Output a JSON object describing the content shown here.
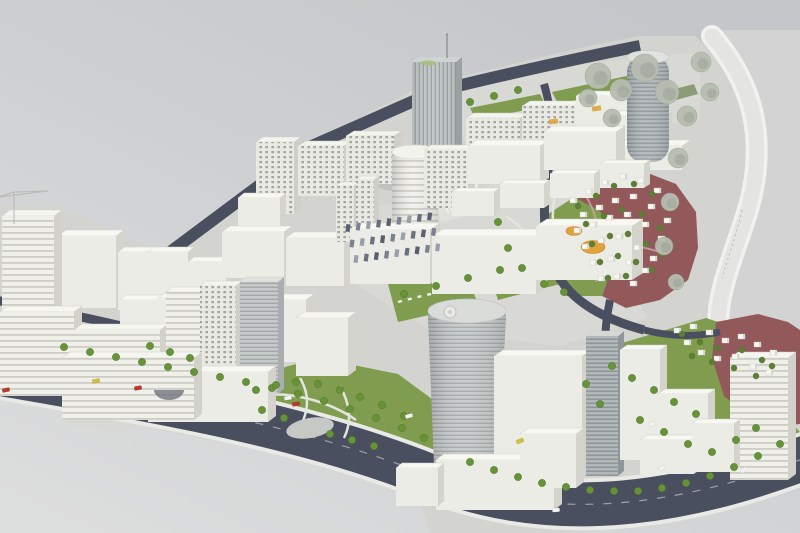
{
  "image": {
    "title": "Architectural scale model of a city district master plan",
    "width": 800,
    "height": 533
  },
  "palette": {
    "bg_top": "#C4C6C9",
    "bg_bottom": "#DCDDDD",
    "platform": "#D3D4CF",
    "pavement": "#D8D9D4",
    "pavement_light": "#E0E1DB",
    "river": "#D2D3D2",
    "bank_road": "#E4E5E2",
    "bank_edge": "#F1F1EE",
    "road": "#4A4F60",
    "road_edge": "#E9E9E5",
    "grass": "#7F9C4F",
    "grass_deep": "#6F8A42",
    "grass_muted": "#8E9B78",
    "path": "#E4E5DE",
    "maroon": "#92585A",
    "maroon_path": "#C9ABA9",
    "orange": "#E0A33C",
    "pond": "#C6C8C6",
    "tree_green": "#679338",
    "tree_green_dark": "#557C2C",
    "tree_red_district": "#5E7D36",
    "tree_gray": "#B7BDB1",
    "tree_gray_dark": "#99A294",
    "house": "#F7F7F2",
    "house_side": "#D8D8D2",
    "car_red": "#B53A31",
    "car_yellow": "#D2C03A",
    "car_white": "#F2F2F0",
    "shadow": "rgba(40,42,50,0.10)",
    "grid_bg": "#E9E9E3",
    "grid_dot": "#A3A49E",
    "ribbon_bg": "#F0F0EB",
    "ribbon_line": "#CDCDC5",
    "glass_bg": "#C6CAC9",
    "glass_line": "#A2A8A9",
    "glassdark_bg": "#B2B8BA",
    "glassdark_line": "#8F969A",
    "vglass_bg": "#C2C8C7",
    "vglass_line": "#9AA1A1"
  },
  "styles": {
    "white": {
      "front": "#ECECE6",
      "top": "#F8F8F3",
      "side": "#D4D4CD"
    },
    "grid": {
      "front": "url(#pat-grid)",
      "top": "#F4F4EE",
      "side": "#CFCFC8"
    },
    "ribbon": {
      "front": "url(#pat-ribbon)",
      "top": "#F6F6F1",
      "side": "#D2D2CB"
    },
    "glass": {
      "front": "url(#pat-h)",
      "top": "#DFE1DF",
      "side": "#A9AEB0"
    },
    "gdark": {
      "front": "url(#pat-hd)",
      "top": "#D6D8D6",
      "side": "#8F969A"
    },
    "vglass": {
      "front": "url(#pat-v)",
      "top": "#CFD4D2",
      "side": "#9AA1A1"
    }
  },
  "buildings_back": [
    [
      "office-slab-a",
      58,
      236,
      58,
      72,
      8,
      6,
      "white"
    ],
    [
      "office-slab-b",
      118,
      252,
      44,
      58,
      7,
      5,
      "white"
    ],
    [
      "construction-highrise",
      2,
      216,
      52,
      96,
      8,
      6,
      "ribbon"
    ],
    [
      "office-box-a",
      148,
      252,
      40,
      42,
      6,
      5,
      "white"
    ],
    [
      "office-box-b",
      188,
      262,
      38,
      36,
      6,
      5,
      "white"
    ],
    [
      "apartment-tower",
      256,
      142,
      38,
      72,
      7,
      5,
      "grid"
    ],
    [
      "apartment-slab-a",
      298,
      146,
      46,
      50,
      8,
      5,
      "grid"
    ],
    [
      "apartment-slab-b",
      346,
      136,
      48,
      48,
      8,
      5,
      "grid"
    ],
    [
      "apartment-slab-c",
      466,
      118,
      54,
      44,
      8,
      5,
      "grid"
    ],
    [
      "apartment-slab-d",
      522,
      106,
      54,
      42,
      8,
      5,
      "grid"
    ],
    [
      "back-block-a",
      576,
      96,
      52,
      38,
      8,
      5,
      "white"
    ],
    [
      "back-block-b",
      610,
      116,
      54,
      34,
      8,
      5,
      "white"
    ],
    [
      "podium-right-tower",
      606,
      146,
      76,
      24,
      9,
      6,
      "white"
    ],
    [
      "podium-center-tower",
      396,
      168,
      82,
      24,
      9,
      6,
      "white"
    ]
  ],
  "buildings_mid": [
    [
      "grid-slab-center",
      424,
      150,
      44,
      58,
      7,
      5,
      "grid"
    ],
    [
      "campus-block-a",
      468,
      146,
      72,
      38,
      9,
      6,
      "white"
    ],
    [
      "campus-block-b",
      544,
      132,
      72,
      38,
      9,
      6,
      "white"
    ],
    [
      "campus-row-a",
      452,
      192,
      42,
      24,
      6,
      4,
      "white"
    ],
    [
      "campus-row-b",
      500,
      184,
      44,
      24,
      6,
      4,
      "white"
    ],
    [
      "campus-row-c",
      550,
      174,
      44,
      24,
      6,
      4,
      "white"
    ],
    [
      "campus-row-d",
      600,
      164,
      44,
      24,
      6,
      4,
      "white"
    ],
    [
      "mid-block-a",
      238,
      198,
      42,
      32,
      6,
      5,
      "white"
    ],
    [
      "mid-block-b",
      222,
      232,
      62,
      46,
      8,
      6,
      "white"
    ],
    [
      "mid-block-c",
      286,
      238,
      58,
      48,
      8,
      6,
      "white"
    ],
    [
      "thin-tower-a",
      336,
      186,
      18,
      56,
      5,
      4,
      "grid"
    ],
    [
      "thin-tower-b",
      356,
      180,
      18,
      60,
      5,
      4,
      "grid"
    ],
    [
      "hall-west",
      350,
      230,
      80,
      54,
      10,
      7,
      "white"
    ],
    [
      "hall-main",
      432,
      236,
      104,
      58,
      11,
      7,
      "white"
    ],
    [
      "hall-east",
      536,
      226,
      96,
      54,
      11,
      7,
      "white"
    ],
    [
      "mid-box-d",
      250,
      300,
      56,
      62,
      8,
      6,
      "white"
    ],
    [
      "mid-box-e",
      296,
      318,
      52,
      58,
      8,
      6,
      "white"
    ],
    [
      "left-box",
      120,
      300,
      40,
      46,
      6,
      5,
      "white"
    ],
    [
      "left-mid-block",
      158,
      298,
      58,
      56,
      8,
      6,
      "white"
    ],
    [
      "ribbon-office-a",
      0,
      312,
      74,
      84,
      8,
      6,
      "ribbon"
    ],
    [
      "ribbon-office-b",
      74,
      330,
      86,
      80,
      8,
      6,
      "ribbon"
    ],
    [
      "front-tower-a",
      166,
      292,
      34,
      96,
      6,
      5,
      "ribbon"
    ],
    [
      "front-tower-b",
      200,
      286,
      36,
      100,
      6,
      5,
      "grid"
    ],
    [
      "front-tower-c",
      240,
      282,
      38,
      112,
      6,
      5,
      "glass"
    ],
    [
      "terrace-podium",
      148,
      372,
      120,
      50,
      8,
      6,
      "white"
    ],
    [
      "curved-complex",
      62,
      358,
      132,
      62,
      8,
      6,
      "ribbon"
    ]
  ],
  "buildings_front": [
    [
      "tower-annex",
      494,
      356,
      88,
      106,
      9,
      6,
      "white"
    ],
    [
      "front-low-a",
      436,
      460,
      118,
      50,
      8,
      6,
      "white"
    ],
    [
      "front-low-b",
      396,
      468,
      42,
      38,
      6,
      5,
      "white"
    ],
    [
      "glass-slab-east",
      586,
      336,
      32,
      140,
      6,
      5,
      "gdark"
    ],
    [
      "white-slab-east",
      620,
      350,
      40,
      110,
      7,
      5,
      "white"
    ],
    [
      "east-box-a",
      658,
      394,
      50,
      44,
      7,
      5,
      "white"
    ],
    [
      "east-box-b",
      640,
      440,
      54,
      34,
      7,
      5,
      "white"
    ],
    [
      "corner-slab",
      730,
      358,
      58,
      122,
      8,
      6,
      "ribbon"
    ],
    [
      "corner-box",
      692,
      424,
      42,
      48,
      6,
      5,
      "white"
    ],
    [
      "south-box",
      520,
      434,
      56,
      54,
      8,
      6,
      "white"
    ]
  ],
  "trees": {
    "green": [
      [
        64,
        347
      ],
      [
        90,
        352
      ],
      [
        116,
        357
      ],
      [
        142,
        362
      ],
      [
        168,
        367
      ],
      [
        194,
        372
      ],
      [
        220,
        377
      ],
      [
        246,
        382
      ],
      [
        272,
        388
      ],
      [
        298,
        394
      ],
      [
        324,
        401
      ],
      [
        350,
        409
      ],
      [
        376,
        418
      ],
      [
        402,
        428
      ],
      [
        424,
        438
      ],
      [
        470,
        462
      ],
      [
        494,
        470
      ],
      [
        518,
        477
      ],
      [
        542,
        483
      ],
      [
        566,
        487
      ],
      [
        590,
        490
      ],
      [
        614,
        491
      ],
      [
        638,
        491
      ],
      [
        662,
        488
      ],
      [
        686,
        483
      ],
      [
        710,
        476
      ],
      [
        734,
        467
      ],
      [
        758,
        456
      ],
      [
        780,
        444
      ],
      [
        256,
        390
      ],
      [
        276,
        385
      ],
      [
        296,
        382
      ],
      [
        318,
        384
      ],
      [
        340,
        390
      ],
      [
        360,
        397
      ],
      [
        382,
        405
      ],
      [
        404,
        416
      ],
      [
        262,
        410
      ],
      [
        284,
        418
      ],
      [
        330,
        434
      ],
      [
        352,
        440
      ],
      [
        374,
        446
      ],
      [
        404,
        294
      ],
      [
        436,
        286
      ],
      [
        468,
        278
      ],
      [
        500,
        270
      ],
      [
        612,
        366
      ],
      [
        632,
        378
      ],
      [
        654,
        390
      ],
      [
        674,
        402
      ],
      [
        696,
        414
      ],
      [
        640,
        420
      ],
      [
        664,
        432
      ],
      [
        688,
        444
      ],
      [
        712,
        452
      ],
      [
        600,
        404
      ],
      [
        586,
        384
      ],
      [
        736,
        440
      ],
      [
        756,
        428
      ],
      [
        470,
        102
      ],
      [
        494,
        96
      ],
      [
        518,
        90
      ],
      [
        150,
        346
      ],
      [
        170,
        352
      ],
      [
        190,
        358
      ],
      [
        498,
        222
      ],
      [
        508,
        248
      ],
      [
        522,
        268
      ],
      [
        544,
        284
      ],
      [
        564,
        292
      ]
    ],
    "dark": [
      [
        578,
        206
      ],
      [
        596,
        196
      ],
      [
        614,
        186
      ],
      [
        634,
        184
      ],
      [
        652,
        194
      ],
      [
        668,
        208
      ],
      [
        586,
        224
      ],
      [
        604,
        216
      ],
      [
        622,
        210
      ],
      [
        642,
        214
      ],
      [
        660,
        228
      ],
      [
        592,
        244
      ],
      [
        610,
        236
      ],
      [
        628,
        234
      ],
      [
        646,
        244
      ],
      [
        662,
        254
      ],
      [
        600,
        262
      ],
      [
        618,
        256
      ],
      [
        636,
        262
      ],
      [
        652,
        270
      ],
      [
        608,
        278
      ],
      [
        626,
        276
      ],
      [
        682,
        334
      ],
      [
        700,
        342
      ],
      [
        718,
        348
      ],
      [
        742,
        350
      ],
      [
        762,
        360
      ],
      [
        692,
        356
      ],
      [
        712,
        362
      ],
      [
        734,
        368
      ],
      [
        756,
        376
      ],
      [
        772,
        366
      ]
    ],
    "gray": [
      [
        598,
        76,
        13
      ],
      [
        621,
        90,
        11
      ],
      [
        645,
        68,
        14
      ],
      [
        667,
        92,
        12
      ],
      [
        687,
        116,
        10
      ],
      [
        701,
        62,
        10
      ],
      [
        710,
        92,
        9
      ],
      [
        678,
        158,
        10
      ],
      [
        670,
        202,
        9
      ],
      [
        664,
        246,
        9
      ],
      [
        676,
        282,
        8
      ],
      [
        612,
        118,
        9
      ],
      [
        588,
        98,
        9
      ]
    ]
  },
  "houses": {
    "hillside": [
      [
        570,
        198
      ],
      [
        586,
        189
      ],
      [
        602,
        180
      ],
      [
        620,
        174
      ],
      [
        638,
        178
      ],
      [
        654,
        188
      ],
      [
        670,
        200
      ],
      [
        580,
        212
      ],
      [
        596,
        205
      ],
      [
        612,
        198
      ],
      [
        630,
        194
      ],
      [
        648,
        204
      ],
      [
        664,
        218
      ],
      [
        574,
        228
      ],
      [
        590,
        222
      ],
      [
        606,
        215
      ],
      [
        624,
        212
      ],
      [
        642,
        222
      ],
      [
        658,
        236
      ],
      [
        582,
        244
      ],
      [
        598,
        238
      ],
      [
        616,
        234
      ],
      [
        634,
        245
      ],
      [
        650,
        256
      ],
      [
        590,
        260
      ],
      [
        608,
        256
      ],
      [
        626,
        260
      ],
      [
        642,
        268
      ],
      [
        598,
        276
      ],
      [
        614,
        274
      ],
      [
        630,
        281
      ]
    ],
    "corner": [
      [
        674,
        328
      ],
      [
        690,
        324
      ],
      [
        706,
        330
      ],
      [
        722,
        338
      ],
      [
        738,
        334
      ],
      [
        754,
        342
      ],
      [
        770,
        350
      ],
      [
        698,
        350
      ],
      [
        714,
        356
      ],
      [
        732,
        354
      ],
      [
        750,
        364
      ],
      [
        766,
        370
      ],
      [
        684,
        340
      ]
    ]
  },
  "cars": [
    [
      6,
      390,
      -12,
      "red"
    ],
    [
      96,
      381,
      -10,
      "yellow"
    ],
    [
      138,
      388,
      -10,
      "red"
    ],
    [
      288,
      398,
      -9,
      "white"
    ],
    [
      296,
      404,
      -9,
      "red"
    ],
    [
      409,
      416,
      -16,
      "white"
    ],
    [
      520,
      441,
      -20,
      "yellow"
    ],
    [
      652,
      424,
      -22,
      "white"
    ],
    [
      662,
      468,
      -26,
      "white"
    ],
    [
      556,
      510,
      -6,
      "white"
    ],
    [
      744,
      470,
      -32,
      "white"
    ]
  ],
  "parking": {
    "rows": 3,
    "cols": 9,
    "start_x": 348,
    "start_y": 228,
    "col_dx": 10.2,
    "col_dy": -1.45,
    "row_dx": 4,
    "row_dy": 15.5,
    "car_w": 4.2,
    "car_h": 7.6,
    "colors": [
      "#5B6070",
      "#7B8190",
      "#99A0AC",
      "#6A7080"
    ]
  }
}
